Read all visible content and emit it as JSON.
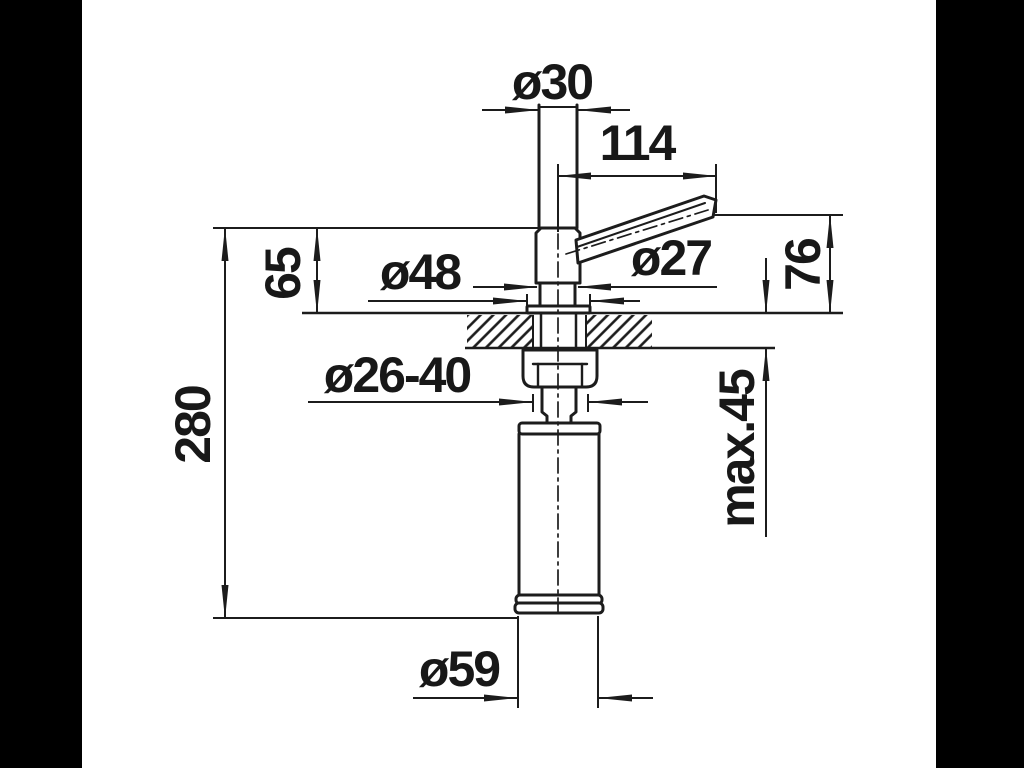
{
  "drawing": {
    "type": "dimensioned installation drawing (soap dispenser, section through countertop)",
    "colors": {
      "background": "#ffffff",
      "matte": "#000000",
      "line": "#1c1c1c",
      "text": "#181818"
    },
    "labels": {
      "shaft_diameter": "ø30",
      "spout_reach": "114",
      "head_height_above_counter": "65",
      "flange_diameter": "ø48",
      "head_diameter": "ø27",
      "spout_height_above_counter": "76",
      "overall_height": "280",
      "mounting_hole_diameter": "ø26-40",
      "max_counter_thickness": "max.45",
      "bottle_diameter": "ø59"
    }
  }
}
